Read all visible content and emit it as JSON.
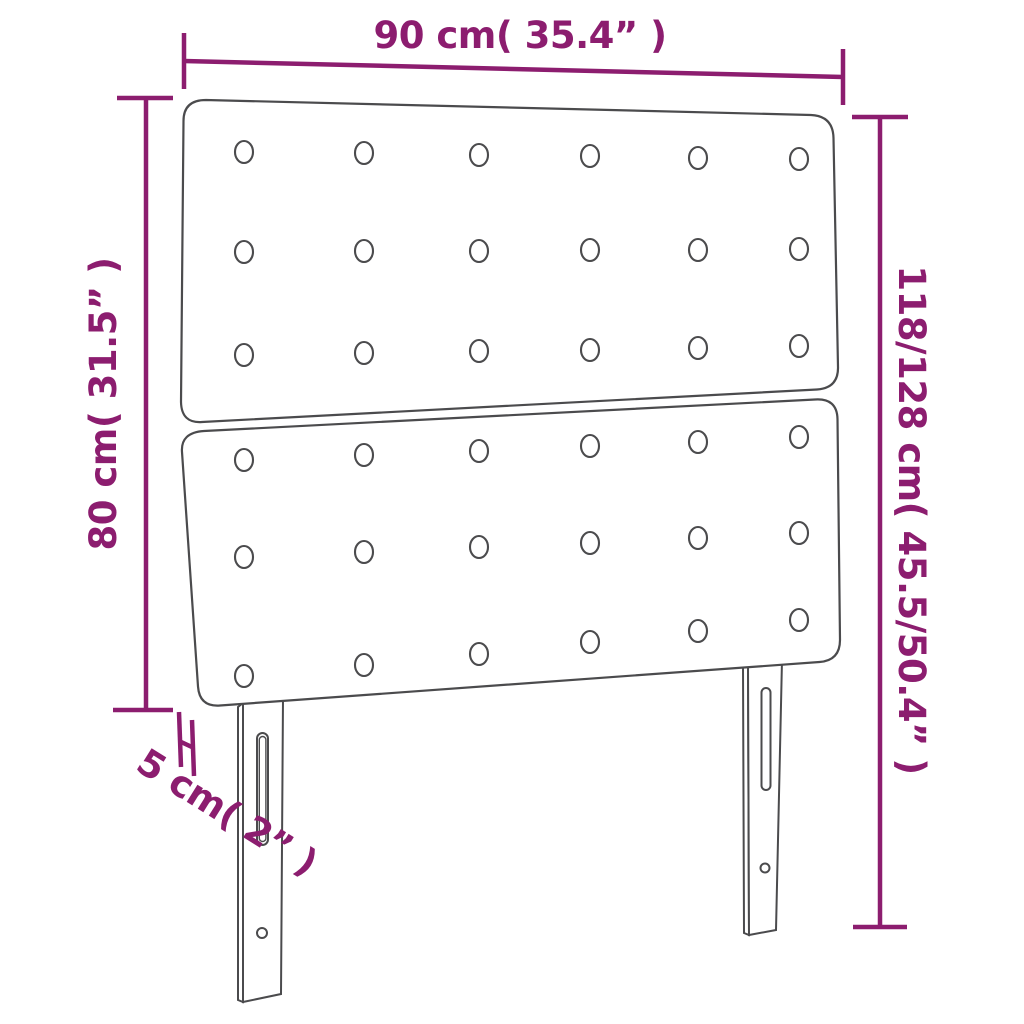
{
  "diagram": {
    "title": "headboard dimension diagram",
    "colors": {
      "dimension_accent": "#8C1D6F",
      "outline_gray": "#4b4b4d",
      "background": "#ffffff"
    },
    "dimensions": {
      "width_top": "90 cm( 35.4” )",
      "height_left": "80 cm( 31.5” )",
      "height_right": "118/128 cm( 45.5/50.4” )",
      "thickness_bottom_left": "5 cm( 2” )"
    },
    "features": {
      "panels": 2,
      "button_columns": 6,
      "button_rows_per_panel": 3,
      "legs": 2,
      "slots_per_leg": 1,
      "screw_holes_per_leg": 1
    }
  }
}
